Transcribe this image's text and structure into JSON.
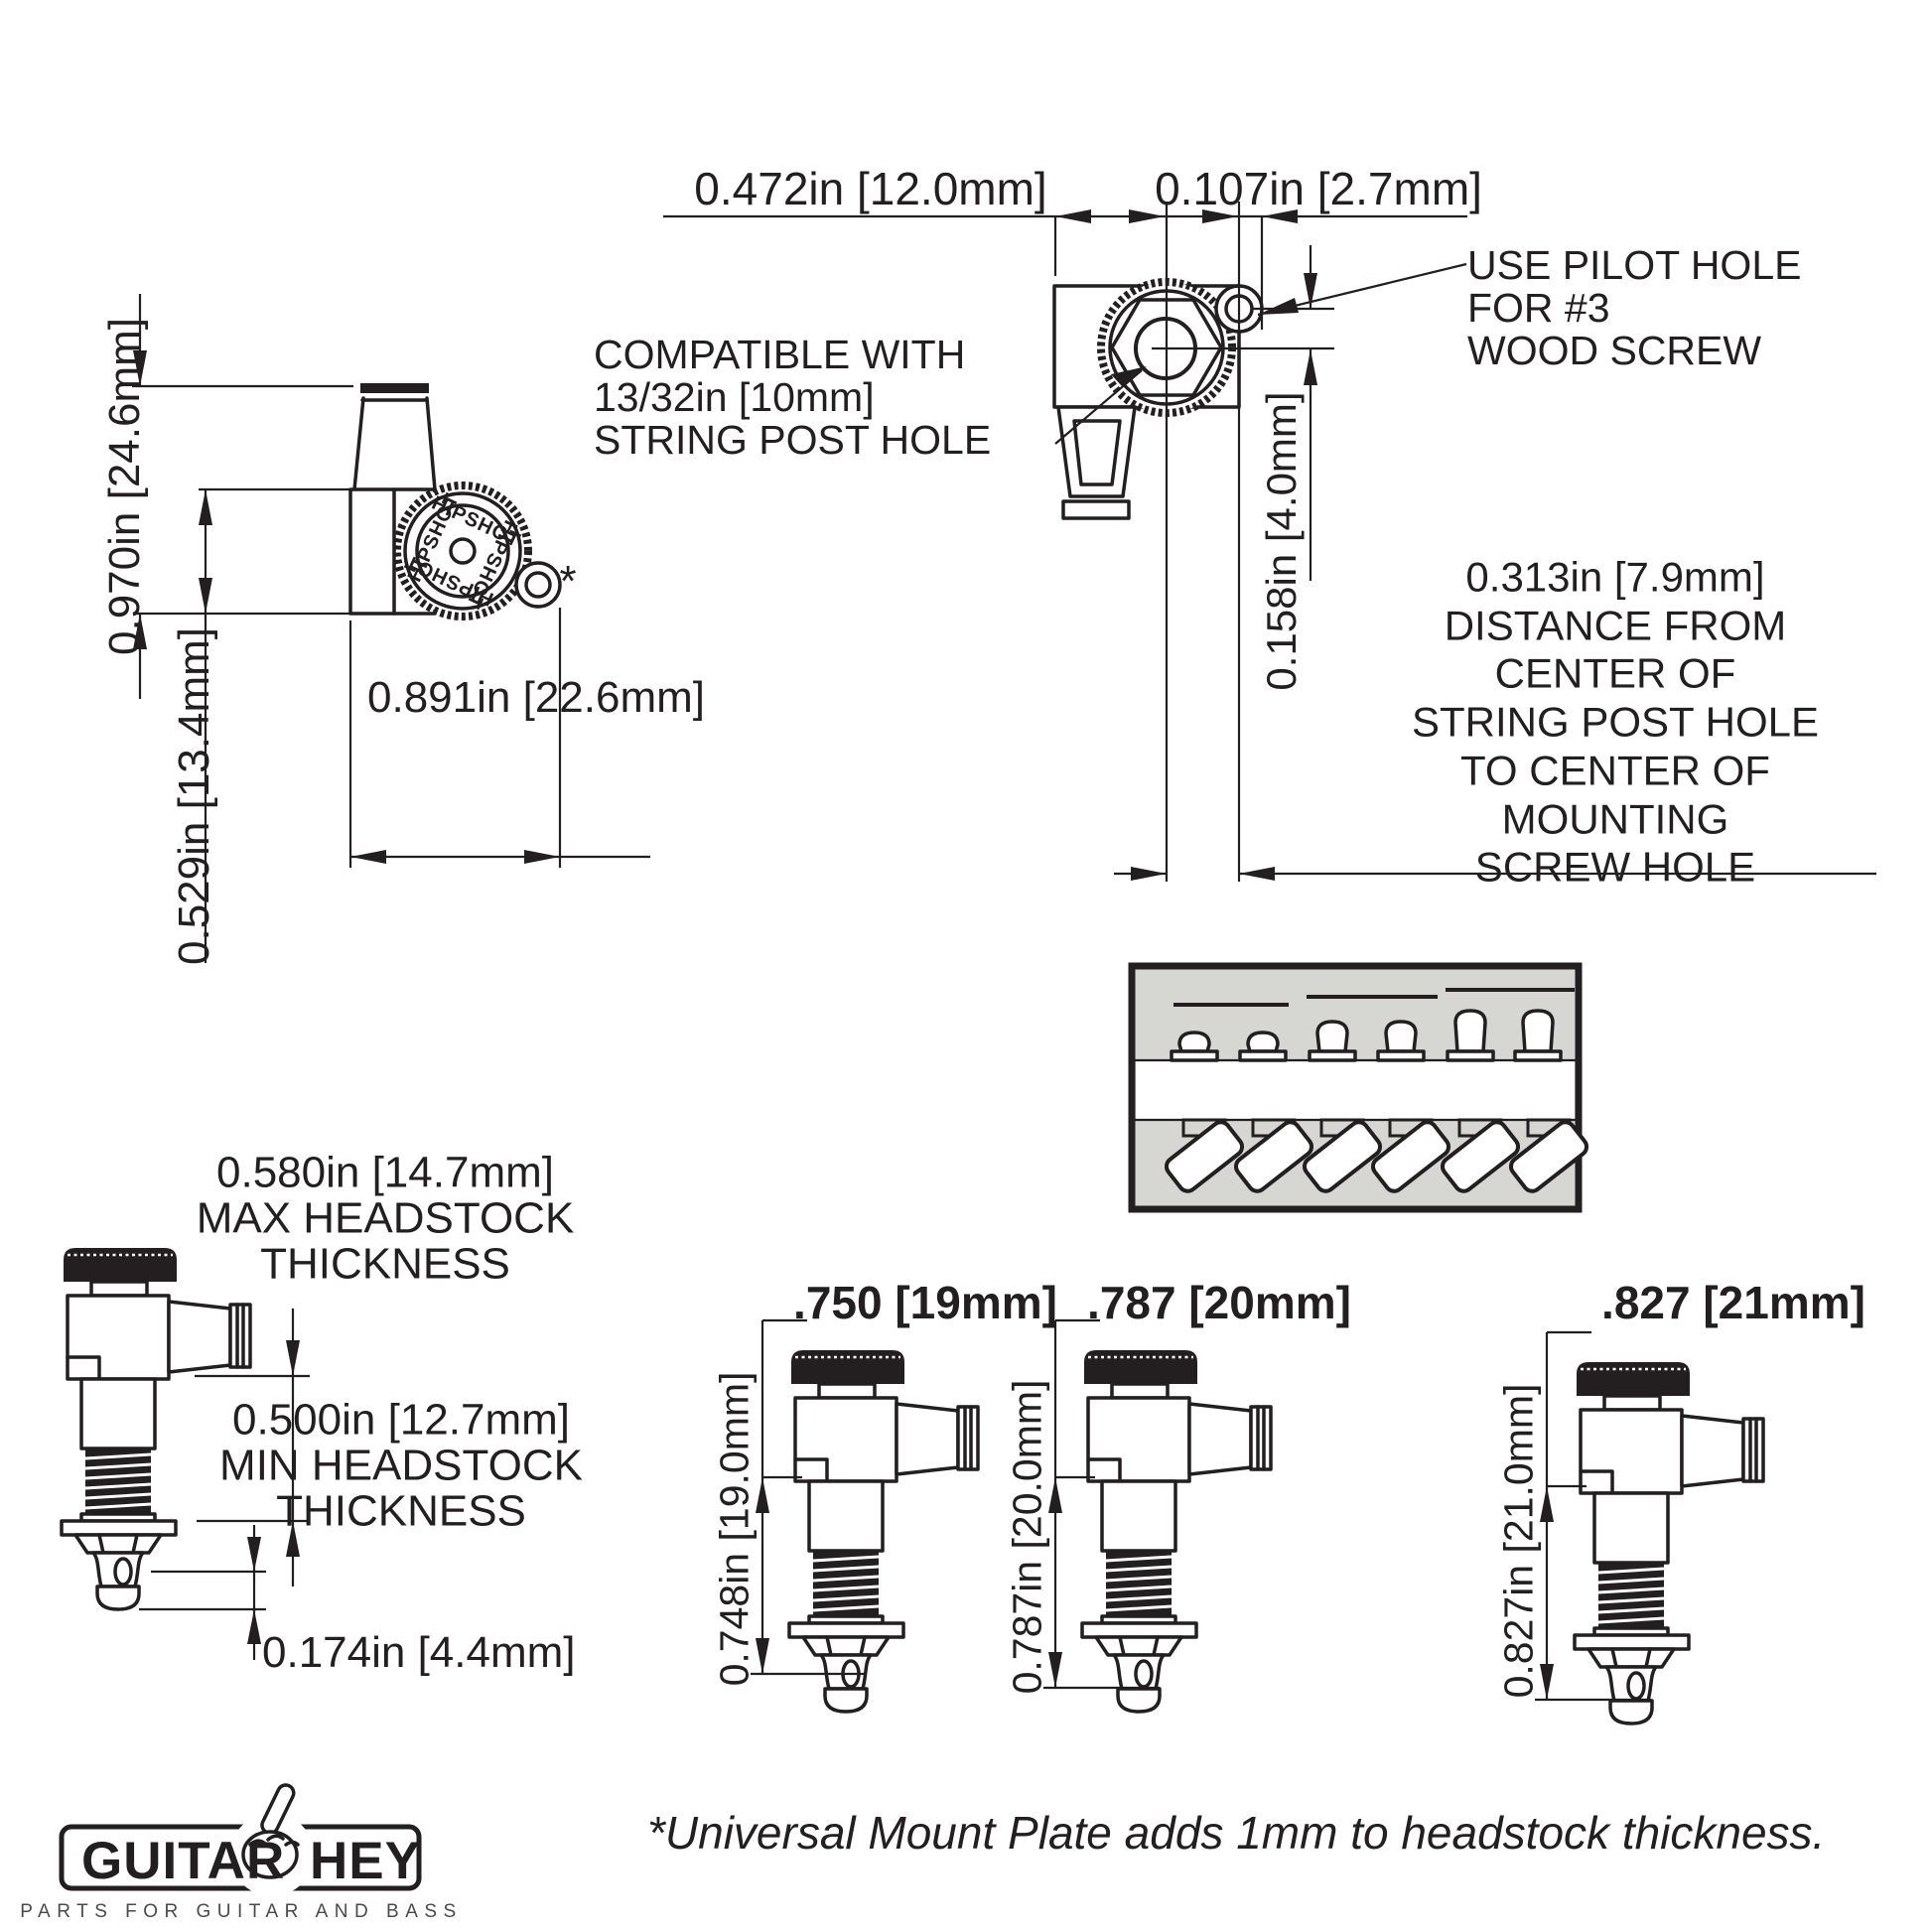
{
  "page": {
    "background": "#ffffff",
    "ink": "#231f20",
    "inset_bg": "#d6d6d3"
  },
  "side_view": {
    "dim_height": "0.970in [24.6mm]",
    "dim_body": "0.529in [13.4mm]",
    "dim_width": "0.891in [22.6mm]",
    "knob_brand": "HIPSHOT",
    "footnote_marker": "*"
  },
  "top_view": {
    "dim_width": "0.472in [12.0mm]",
    "dim_tab": "0.107in [2.7mm]",
    "dim_offset_v": "0.158in [4.0mm]",
    "pilot_note": [
      "USE PILOT HOLE",
      "FOR #3",
      "WOOD SCREW"
    ],
    "compat_note": [
      "COMPATIBLE WITH",
      "13/32in [10mm]",
      "STRING POST HOLE"
    ],
    "distance_note": [
      "0.313in [7.9mm]",
      "DISTANCE FROM",
      "CENTER OF",
      "STRING POST HOLE",
      "TO CENTER OF",
      "MOUNTING",
      "SCREW HOLE"
    ]
  },
  "front_view": {
    "dim_max": "0.580in [14.7mm]",
    "max_note": [
      "MAX HEADSTOCK",
      "THICKNESS"
    ],
    "dim_min": "0.500in [12.7mm]",
    "min_note": [
      "MIN HEADSTOCK",
      "THICKNESS"
    ],
    "dim_tip": "0.174in [4.4mm]"
  },
  "variants": [
    {
      "label": ".750 [19mm]",
      "dim": "0.748in [19.0mm]"
    },
    {
      "label": ".787 [20mm]",
      "dim": "0.787in [20.0mm]"
    },
    {
      "label": ".827 [21mm]",
      "dim": "0.827in [21.0mm]"
    }
  ],
  "footer": {
    "brand_left": "GUITAR",
    "brand_right": "HEY",
    "tagline": "PARTS FOR GUITAR AND BASS",
    "note": "*Universal Mount Plate adds 1mm to headstock thickness."
  }
}
